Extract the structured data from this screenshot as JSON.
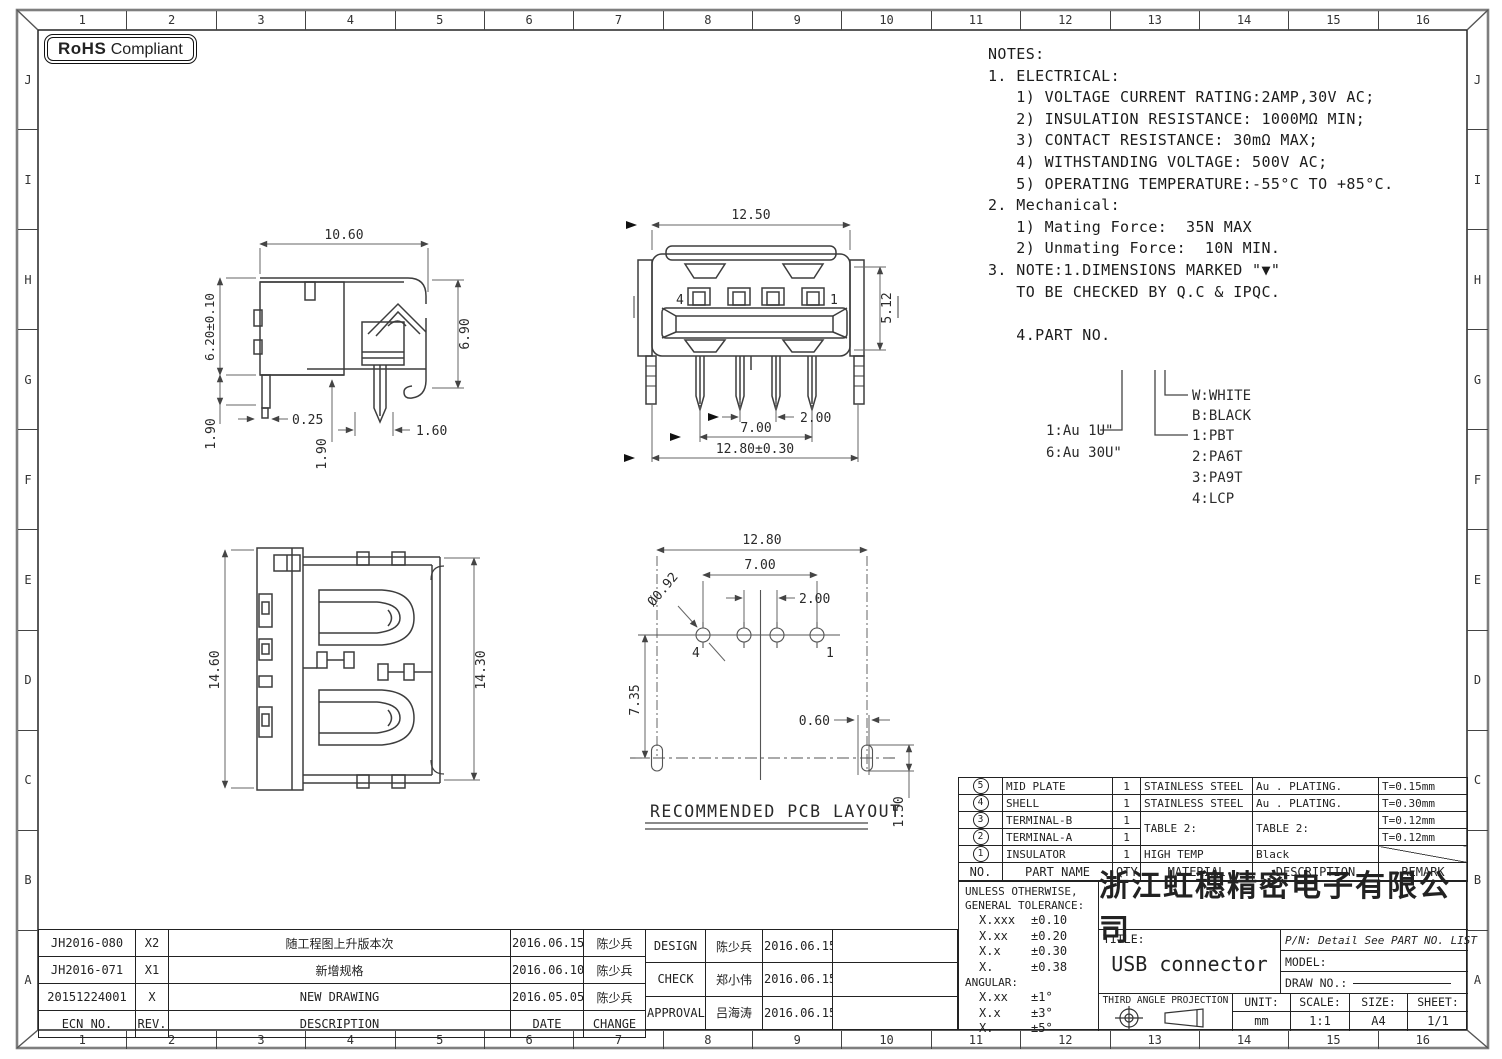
{
  "frame": {
    "top_numbers": [
      "1",
      "2",
      "3",
      "4",
      "5",
      "6",
      "7",
      "8",
      "9",
      "10",
      "11",
      "12",
      "13",
      "14",
      "15",
      "16"
    ],
    "side_letters": [
      "J",
      "I",
      "H",
      "G",
      "F",
      "E",
      "D",
      "C",
      "B",
      "A"
    ]
  },
  "badge": {
    "bold": "RoHS",
    "text": "Compliant"
  },
  "notes_lines": [
    "NOTES:",
    "1. ELECTRICAL:",
    "   1) VOLTAGE CURRENT RATING:2AMP,30V AC;",
    "   2) INSULATION RESISTANCE: 1000MΩ MIN;",
    "   3) CONTACT RESISTANCE: 30mΩ MAX;",
    "   4) WITHSTANDING VOLTAGE: 500V AC;",
    "   5) OPERATING TEMPERATURE:-55°C TO +85°C.",
    "2. Mechanical:",
    "   1) Mating Force:  35N MAX",
    "   2) Unmating Force:  10N MIN.",
    "3. NOTE:1.DIMENSIONS MARKED \"▼\"",
    "   TO BE CHECKED BY Q.C & IPQC.",
    "",
    "   4.PART NO."
  ],
  "legend": {
    "plating_1": "1:Au 1U\"",
    "plating_2": "6:Au 30U\"",
    "color_1": "W:WHITE",
    "color_2": "B:BLACK",
    "material_1": "1:PBT",
    "material_2": "2:PA6T",
    "material_3": "3:PA9T",
    "material_4": "4:LCP"
  },
  "views": {
    "side": {
      "dim_w": "10.60",
      "dim_h_left": "6.20±0.10",
      "dim_h_right": "6.90",
      "dim_leg": "1.90",
      "dim_offset": "0.25",
      "dim_pin_h": "1.90",
      "dim_pin_w": "1.60"
    },
    "front": {
      "dim_w": "12.50",
      "dim_h": "5.12",
      "dim_pitch": "2.00",
      "dim_span": "7.00",
      "dim_total": "12.80±0.30",
      "pin_last": "4",
      "pin_first": "1"
    },
    "top": {
      "dim_h_left": "14.60",
      "dim_h_right": "14.30"
    },
    "pcb": {
      "dim_total": "12.80",
      "dim_span": "7.00",
      "dim_pitch": "2.00",
      "dim_hole": "Ø0.92",
      "dim_depth": "7.35",
      "dim_slot_w": "0.60",
      "dim_slot_h": "1.50",
      "pin_last": "4",
      "pin_first": "1",
      "caption": "RECOMMENDED PCB LAYOUT"
    }
  },
  "bom": {
    "headers": [
      "NO.",
      "PART NAME",
      "QTY",
      "MATERIAL",
      "DESCRIPTION",
      "REMARK"
    ],
    "rows": [
      {
        "no": "5",
        "name": "MID PLATE",
        "qty": "1",
        "material": "STAINLESS STEEL",
        "desc": "Au . PLATING.",
        "remark": "T=0.15mm"
      },
      {
        "no": "4",
        "name": "SHELL",
        "qty": "1",
        "material": "STAINLESS STEEL",
        "desc": "Au . PLATING.",
        "remark": "T=0.30mm"
      },
      {
        "no": "3",
        "name": "TERMINAL-B",
        "qty": "1",
        "material": "TABLE 2:",
        "desc": "TABLE 2:",
        "remark": "T=0.12mm"
      },
      {
        "no": "2",
        "name": "TERMINAL-A",
        "qty": "1",
        "remark": "T=0.12mm"
      },
      {
        "no": "1",
        "name": "INSULATOR",
        "qty": "1",
        "material": "HIGH TEMP",
        "desc": "Black",
        "remark": ""
      }
    ]
  },
  "tolerance": {
    "line1": "UNLESS OTHERWISE,",
    "line2": "GENERAL TOLERANCE:",
    "rows": [
      [
        "X.xxx",
        "±0.10"
      ],
      [
        "X.xx",
        "±0.20"
      ],
      [
        "X.x",
        "±0.30"
      ],
      [
        "X.",
        "±0.38"
      ]
    ],
    "angular_label": "ANGULAR:",
    "angular_rows": [
      [
        "X.xx",
        "±1°"
      ],
      [
        "X.x",
        "±3°"
      ],
      [
        "X.",
        "±5°"
      ]
    ]
  },
  "title_block": {
    "company": "浙江虹穗精密电子有限公司",
    "title_label": "TITLE:",
    "title": "USB connector",
    "pn": "P/N: Detail See PART NO. LIST",
    "model_label": "MODEL:",
    "drawno_label": "DRAW NO.:",
    "projection": "THIRD ANGLE PROJECTION",
    "unit_label": "UNIT:",
    "unit": "mm",
    "scale_label": "SCALE:",
    "scale": "1:1",
    "size_label": "SIZE:",
    "size": "A4",
    "sheet_label": "SHEET:",
    "sheet": "1/1"
  },
  "revisions": {
    "headers": [
      "ECN NO.",
      "REV.",
      "DESCRIPTION",
      "DATE",
      "CHANGE"
    ],
    "rows": [
      [
        "JH2016-080",
        "X2",
        "随工程图上升版本次",
        "2016.06.15",
        "陈少兵"
      ],
      [
        "JH2016-071",
        "X1",
        "新增规格",
        "2016.06.10",
        "陈少兵"
      ],
      [
        "20151224001",
        "X",
        "NEW DRAWING",
        "2016.05.05",
        "陈少兵"
      ]
    ]
  },
  "signoff": {
    "rows": [
      [
        "DESIGN",
        "陈少兵",
        "2016.06.15"
      ],
      [
        "CHECK",
        "郑小伟",
        "2016.06.15"
      ],
      [
        "APPROVAL",
        "吕海涛",
        "2016.06.15"
      ]
    ]
  }
}
